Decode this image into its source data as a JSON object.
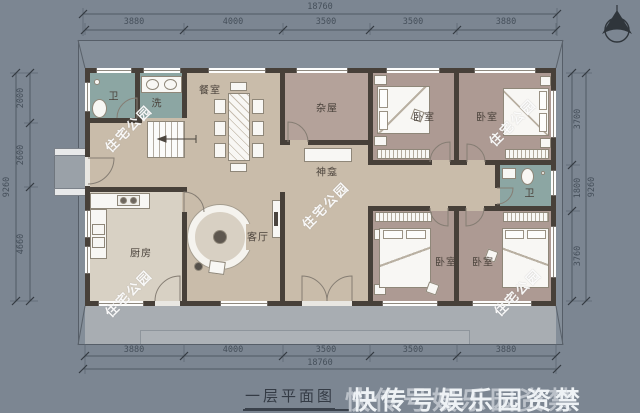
{
  "page": {
    "title": "一层平面图"
  },
  "watermarks": {
    "site": "住宅公园",
    "overlay": "快传号娱乐园资禁"
  },
  "dimensions": {
    "top": {
      "total": "18760",
      "segments": [
        "3880",
        "4000",
        "3500",
        "3500",
        "3880"
      ]
    },
    "bottom": {
      "total": "18760",
      "segments": [
        "3880",
        "4000",
        "3500",
        "3500",
        "3880"
      ]
    },
    "left": {
      "total": "9260",
      "segments": [
        "2000",
        "2600",
        "4660"
      ]
    },
    "right": {
      "total": "9260",
      "segments": [
        "3700",
        "1800",
        "3760"
      ]
    }
  },
  "rooms": {
    "bath_left": "卫",
    "laundry": "洗",
    "dining": "餐室",
    "storage": "杂屋",
    "bedroom_top_mid": "卧室",
    "bedroom_top_right": "卧室",
    "shrine": "神龛",
    "bath_right": "卫",
    "kitchen": "厨房",
    "living": "客厅",
    "bedroom_bottom_mid": "卧室",
    "bedroom_bottom_right": "卧室"
  },
  "colors": {
    "background": "#7c8692",
    "wall": "#474039",
    "floor_tan": "#c9bcaa",
    "floor_bedroom": "#ad9a93",
    "floor_bath": "#8ca6a3",
    "terrace": "#a8adb2"
  }
}
